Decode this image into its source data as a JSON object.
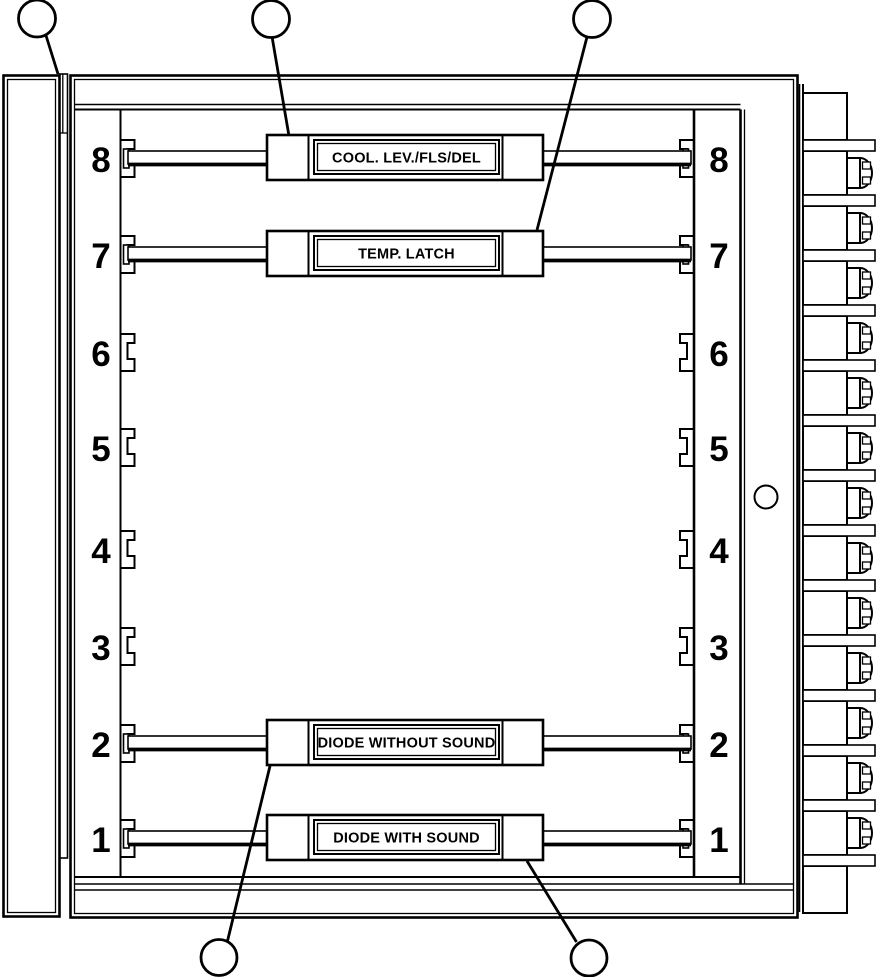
{
  "colors": {
    "line": "#000000",
    "background": "#ffffff"
  },
  "slot_numbers": [
    "8",
    "7",
    "6",
    "5",
    "4",
    "3",
    "2",
    "1"
  ],
  "cards": [
    {
      "slot": "8",
      "label": "COOL. LEV./FLS/DEL"
    },
    {
      "slot": "7",
      "label": "TEMP. LATCH"
    },
    {
      "slot": "2",
      "label": "DIODE WITHOUT SOUND"
    },
    {
      "slot": "1",
      "label": "DIODE WITH SOUND"
    }
  ]
}
